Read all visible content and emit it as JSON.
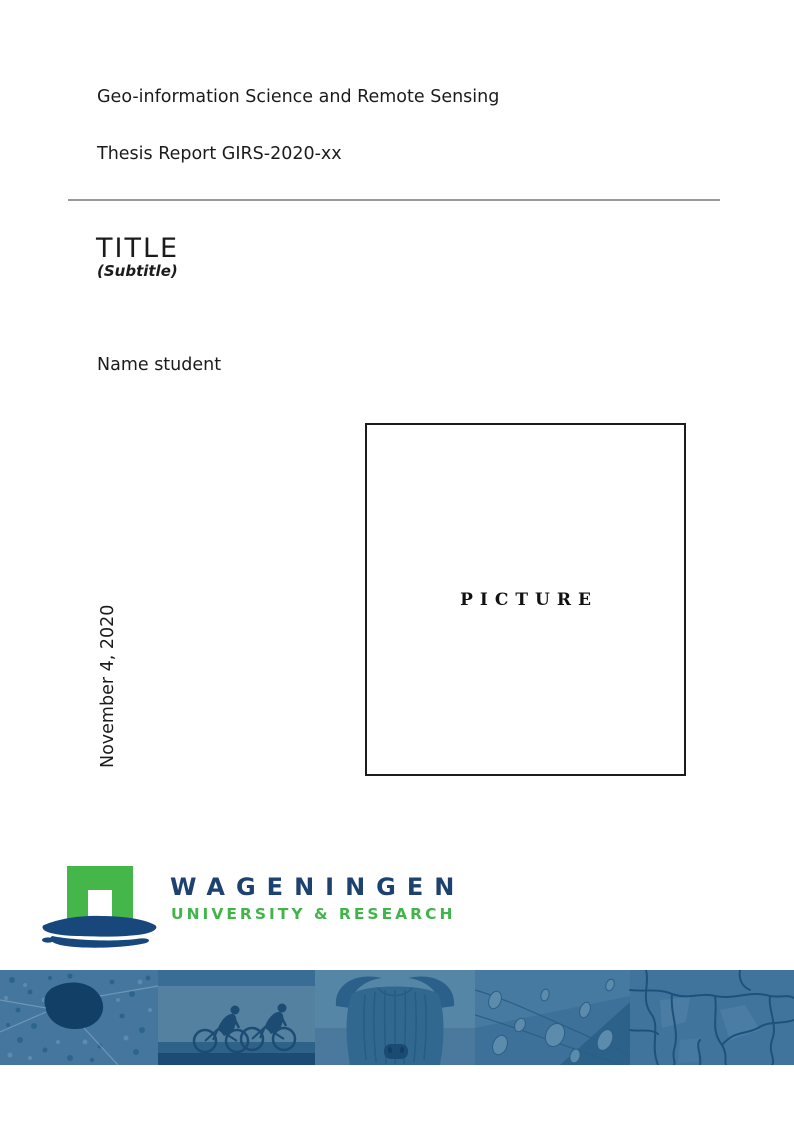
{
  "document": {
    "program": "Geo-information Science and Remote Sensing",
    "report_number": "Thesis Report GIRS-2020-xx",
    "title": "TITLE",
    "subtitle": "(Subtitle)",
    "author": "Name student",
    "date": "November 4, 2020"
  },
  "picture": {
    "placeholder": "PICTURE"
  },
  "logo": {
    "line1": "WAGENINGEN",
    "line2": "UNIVERSITY & RESEARCH",
    "colors": {
      "green": "#45B649",
      "navy": "#1D4270",
      "brush_blue": "#17477B"
    }
  },
  "banner": {
    "overlay_color": "#336C96",
    "photos": [
      {
        "icon": "aerial-map-photo"
      },
      {
        "icon": "cyclists-photo"
      },
      {
        "icon": "highland-cow-photo"
      },
      {
        "icon": "butterfly-wing-droplets-photo"
      },
      {
        "icon": "cracked-earth-photo"
      }
    ]
  }
}
